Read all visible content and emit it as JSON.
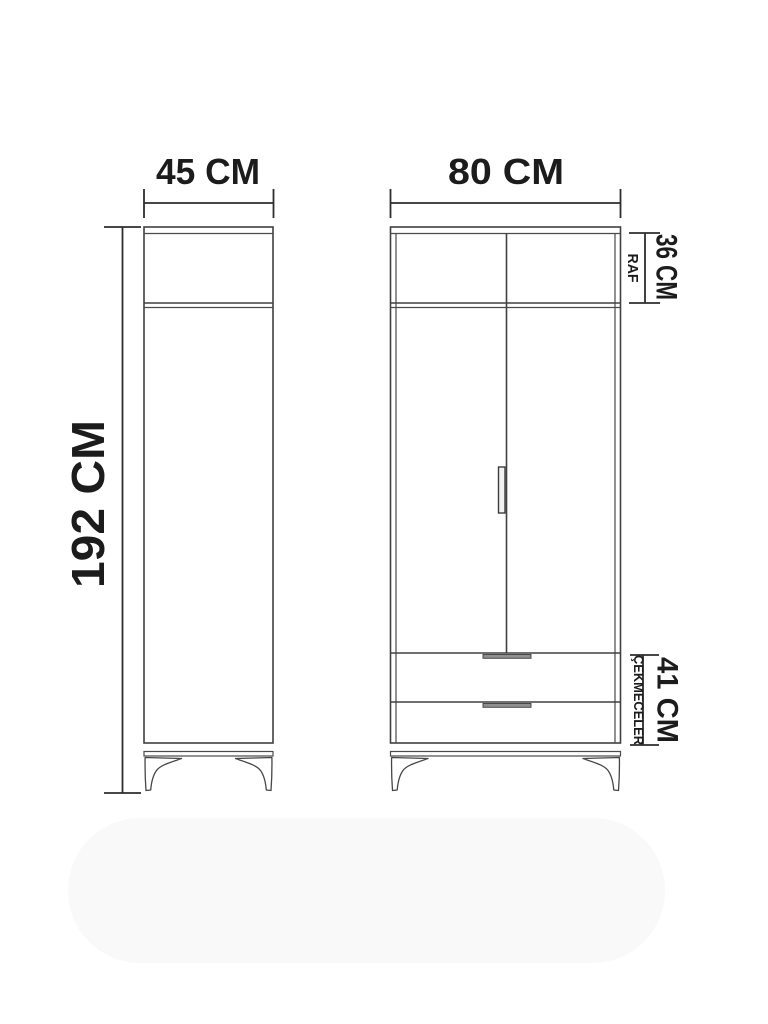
{
  "diagram": {
    "side_view": {
      "width_label": "45 CM"
    },
    "front_view": {
      "width_label": "80 CM"
    },
    "height_label": "192 CM",
    "shelf_section": {
      "height_label": "36 CM",
      "caption": "RAF"
    },
    "drawer_section": {
      "height_label": "41 CM",
      "caption": "ÇEKMECELER"
    }
  },
  "colors": {
    "line": "#404040",
    "dimension": "#2d2d2d",
    "text": "#1c1c1c",
    "background": "#ffffff",
    "floor_shadow": "#f9f9f9"
  }
}
